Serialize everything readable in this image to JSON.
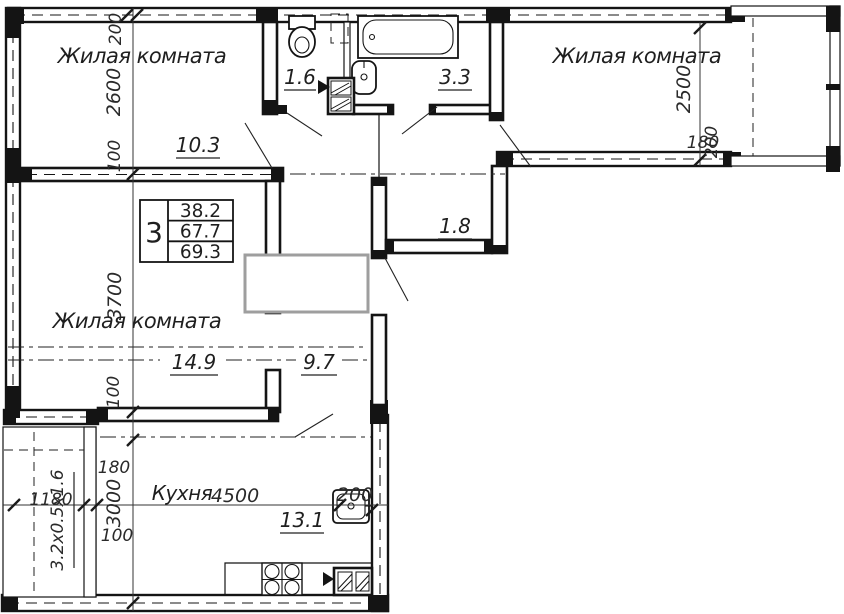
{
  "plan": {
    "rooms": {
      "room_top_left": {
        "name": "Жилая комната",
        "area": "10.3"
      },
      "room_top_right": {
        "name": "Жилая комната"
      },
      "room_mid_left": {
        "name": "Жилая комната",
        "area": "14.9"
      },
      "kitchen": {
        "name": "Кухня",
        "area": "13.1"
      },
      "wc": {
        "area": "1.6"
      },
      "bathroom": {
        "area": "3.3"
      },
      "hallway": {
        "area": "1.8"
      },
      "corridor": {
        "area": "9.7"
      }
    },
    "info_table": {
      "room_count": "3",
      "living_area": "38.2",
      "apartment_area": "67.7",
      "total_area": "69.3"
    },
    "dimensions": {
      "left_chain": {
        "wall_top": "200",
        "room1": "2600",
        "wall_mid": "100",
        "room2": "3700",
        "wall_low": "100",
        "gap": "180",
        "kitchen": "3000",
        "wall_bottom": "100"
      },
      "bottom_chain": {
        "balcony": "1180",
        "kitchen_length": "4500",
        "wall": "200"
      },
      "right_chain": {
        "room_width": "2500",
        "wall_a": "180",
        "wall_b": "200"
      },
      "balcony_size": "3.2х0.5х1.6"
    },
    "colors": {
      "line": "#141414",
      "dim": "#333333",
      "watermark_box": "#9e9e9e"
    }
  }
}
